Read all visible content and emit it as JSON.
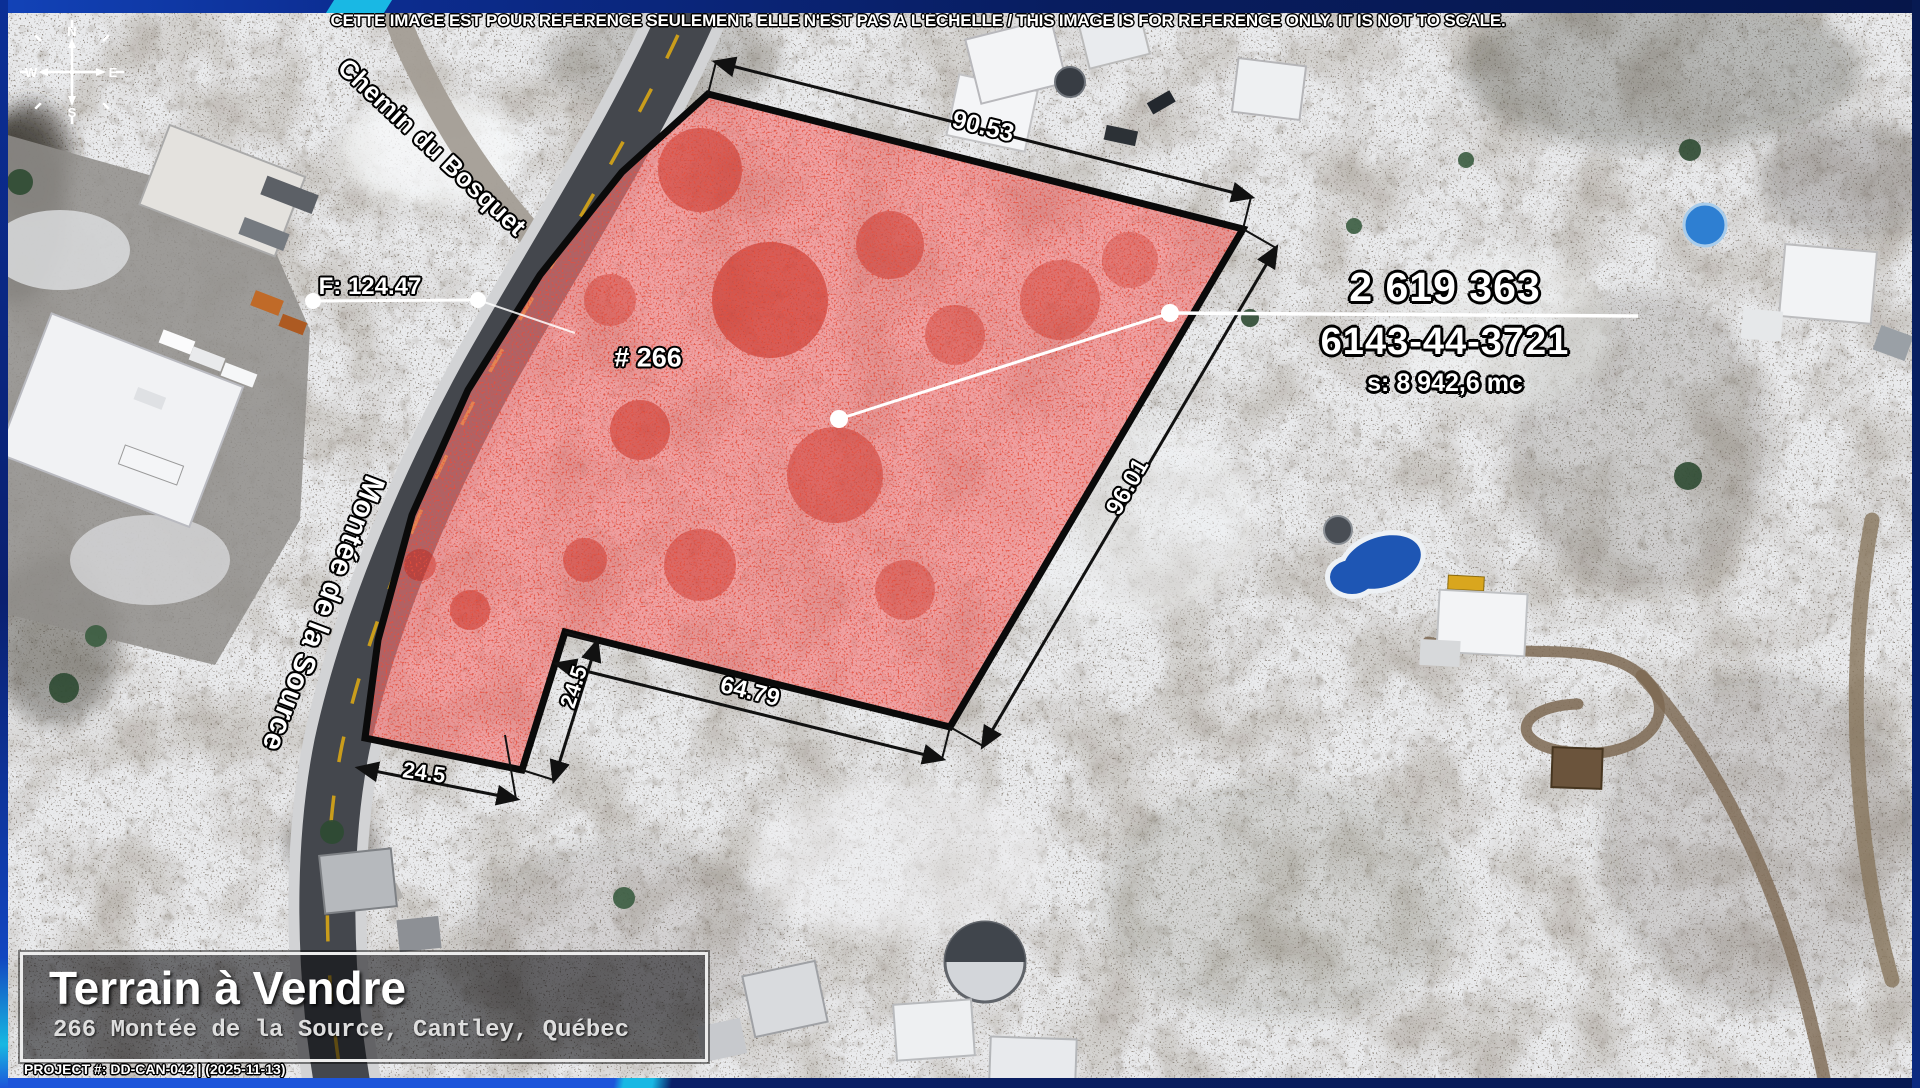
{
  "disclaimer": "CETTE IMAGE EST POUR RÉFÉRENCE SEULEMENT. ELLE N'EST PAS À L'ÉCHELLE / THIS IMAGE IS FOR REFERENCE ONLY. IT IS NOT TO SCALE.",
  "compass": {
    "north": "N",
    "east": "E",
    "south": "S",
    "west": "W"
  },
  "roads": {
    "cross_street": "Chemin du Bosquet",
    "main_street": "Montée de la Source"
  },
  "parcel": {
    "lot_number": "2 619 363",
    "matricule": "6143-44-3721",
    "area": "s: 8 942,6 mc",
    "civic_number": "# 266",
    "frontage": "F: 124.47",
    "dim_top": "90.53",
    "dim_right": "96.01",
    "dim_bottom": "64.79",
    "dim_notch": "24.5",
    "dim_street": "24.5"
  },
  "banner": {
    "title": "Terrain à Vendre",
    "address": "266 Montée de la Source, Cantley, Québec"
  },
  "footer": {
    "project_id": "PROJECT #: DD-CAN-042 | (2025-11-13)"
  },
  "colors": {
    "frame_navy": "#0a2068",
    "frame_blue": "#1d55da",
    "accent_cyan": "#19b8e4",
    "lot_highlight": "#e85050",
    "dimension_text": "#ffffff"
  }
}
